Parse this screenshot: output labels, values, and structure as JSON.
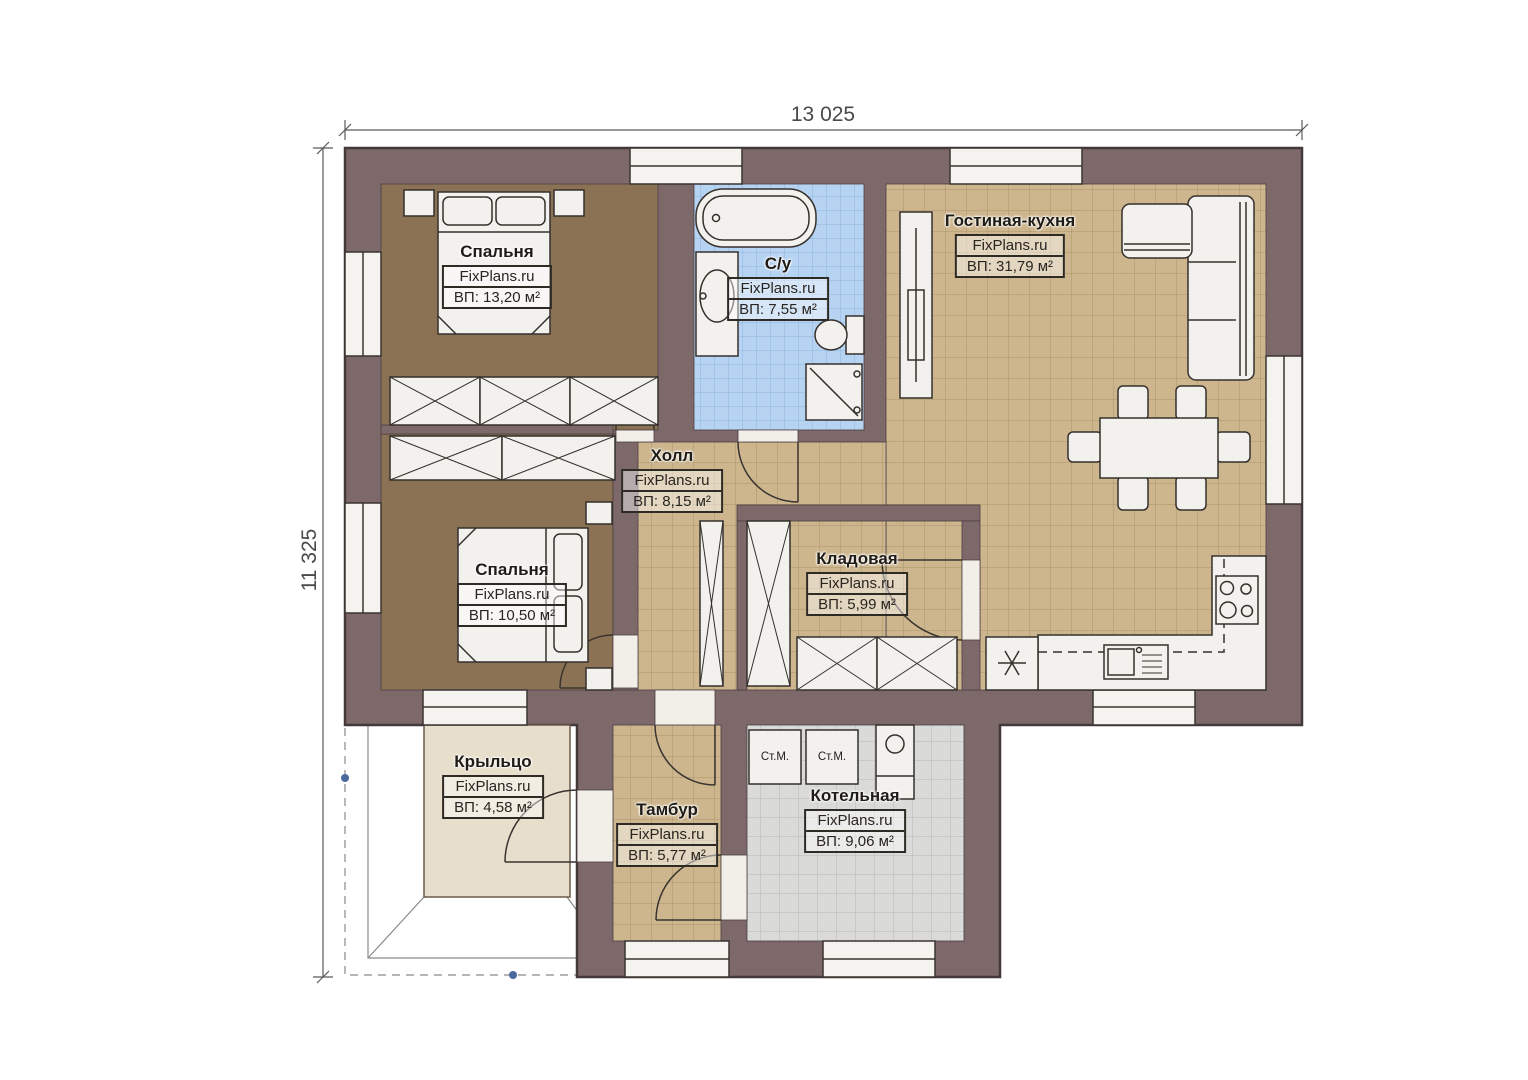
{
  "dimensions": {
    "width_label": "13 025",
    "height_label": "11 325"
  },
  "rooms": [
    {
      "id": "bedroom-1",
      "name": "Спальня",
      "brand": "FixPlans.ru",
      "area": "ВП: 13,20 м²"
    },
    {
      "id": "bathroom",
      "name": "С/у",
      "brand": "FixPlans.ru",
      "area": "ВП: 7,55 м²"
    },
    {
      "id": "living-kitchen",
      "name": "Гостиная-кухня",
      "brand": "FixPlans.ru",
      "area": "ВП: 31,79 м²"
    },
    {
      "id": "hall",
      "name": "Холл",
      "brand": "FixPlans.ru",
      "area": "ВП: 8,15 м²"
    },
    {
      "id": "bedroom-2",
      "name": "Спальня",
      "brand": "FixPlans.ru",
      "area": "ВП: 10,50 м²"
    },
    {
      "id": "storage",
      "name": "Кладовая",
      "brand": "FixPlans.ru",
      "area": "ВП: 5,99 м²"
    },
    {
      "id": "porch",
      "name": "Крыльцо",
      "brand": "FixPlans.ru",
      "area": "ВП: 4,58 м²"
    },
    {
      "id": "vestibule",
      "name": "Тамбур",
      "brand": "FixPlans.ru",
      "area": "ВП: 5,77 м²"
    },
    {
      "id": "boiler-room",
      "name": "Котельная",
      "brand": "FixPlans.ru",
      "area": "ВП: 9,06 м²"
    }
  ],
  "appliances": {
    "washing_machine_1": "Ст.М.",
    "washing_machine_2": "Ст.М."
  },
  "colors": {
    "wall": "#7d686a",
    "floor_tile_tan": "#cdb68e",
    "floor_bedroom": "#8b7254",
    "floor_bath": "#b7d3f2",
    "floor_boiler": "#dadad8",
    "floor_porch": "#e7decb",
    "furniture": "#f2f1ee",
    "outline": "#3a332f"
  }
}
